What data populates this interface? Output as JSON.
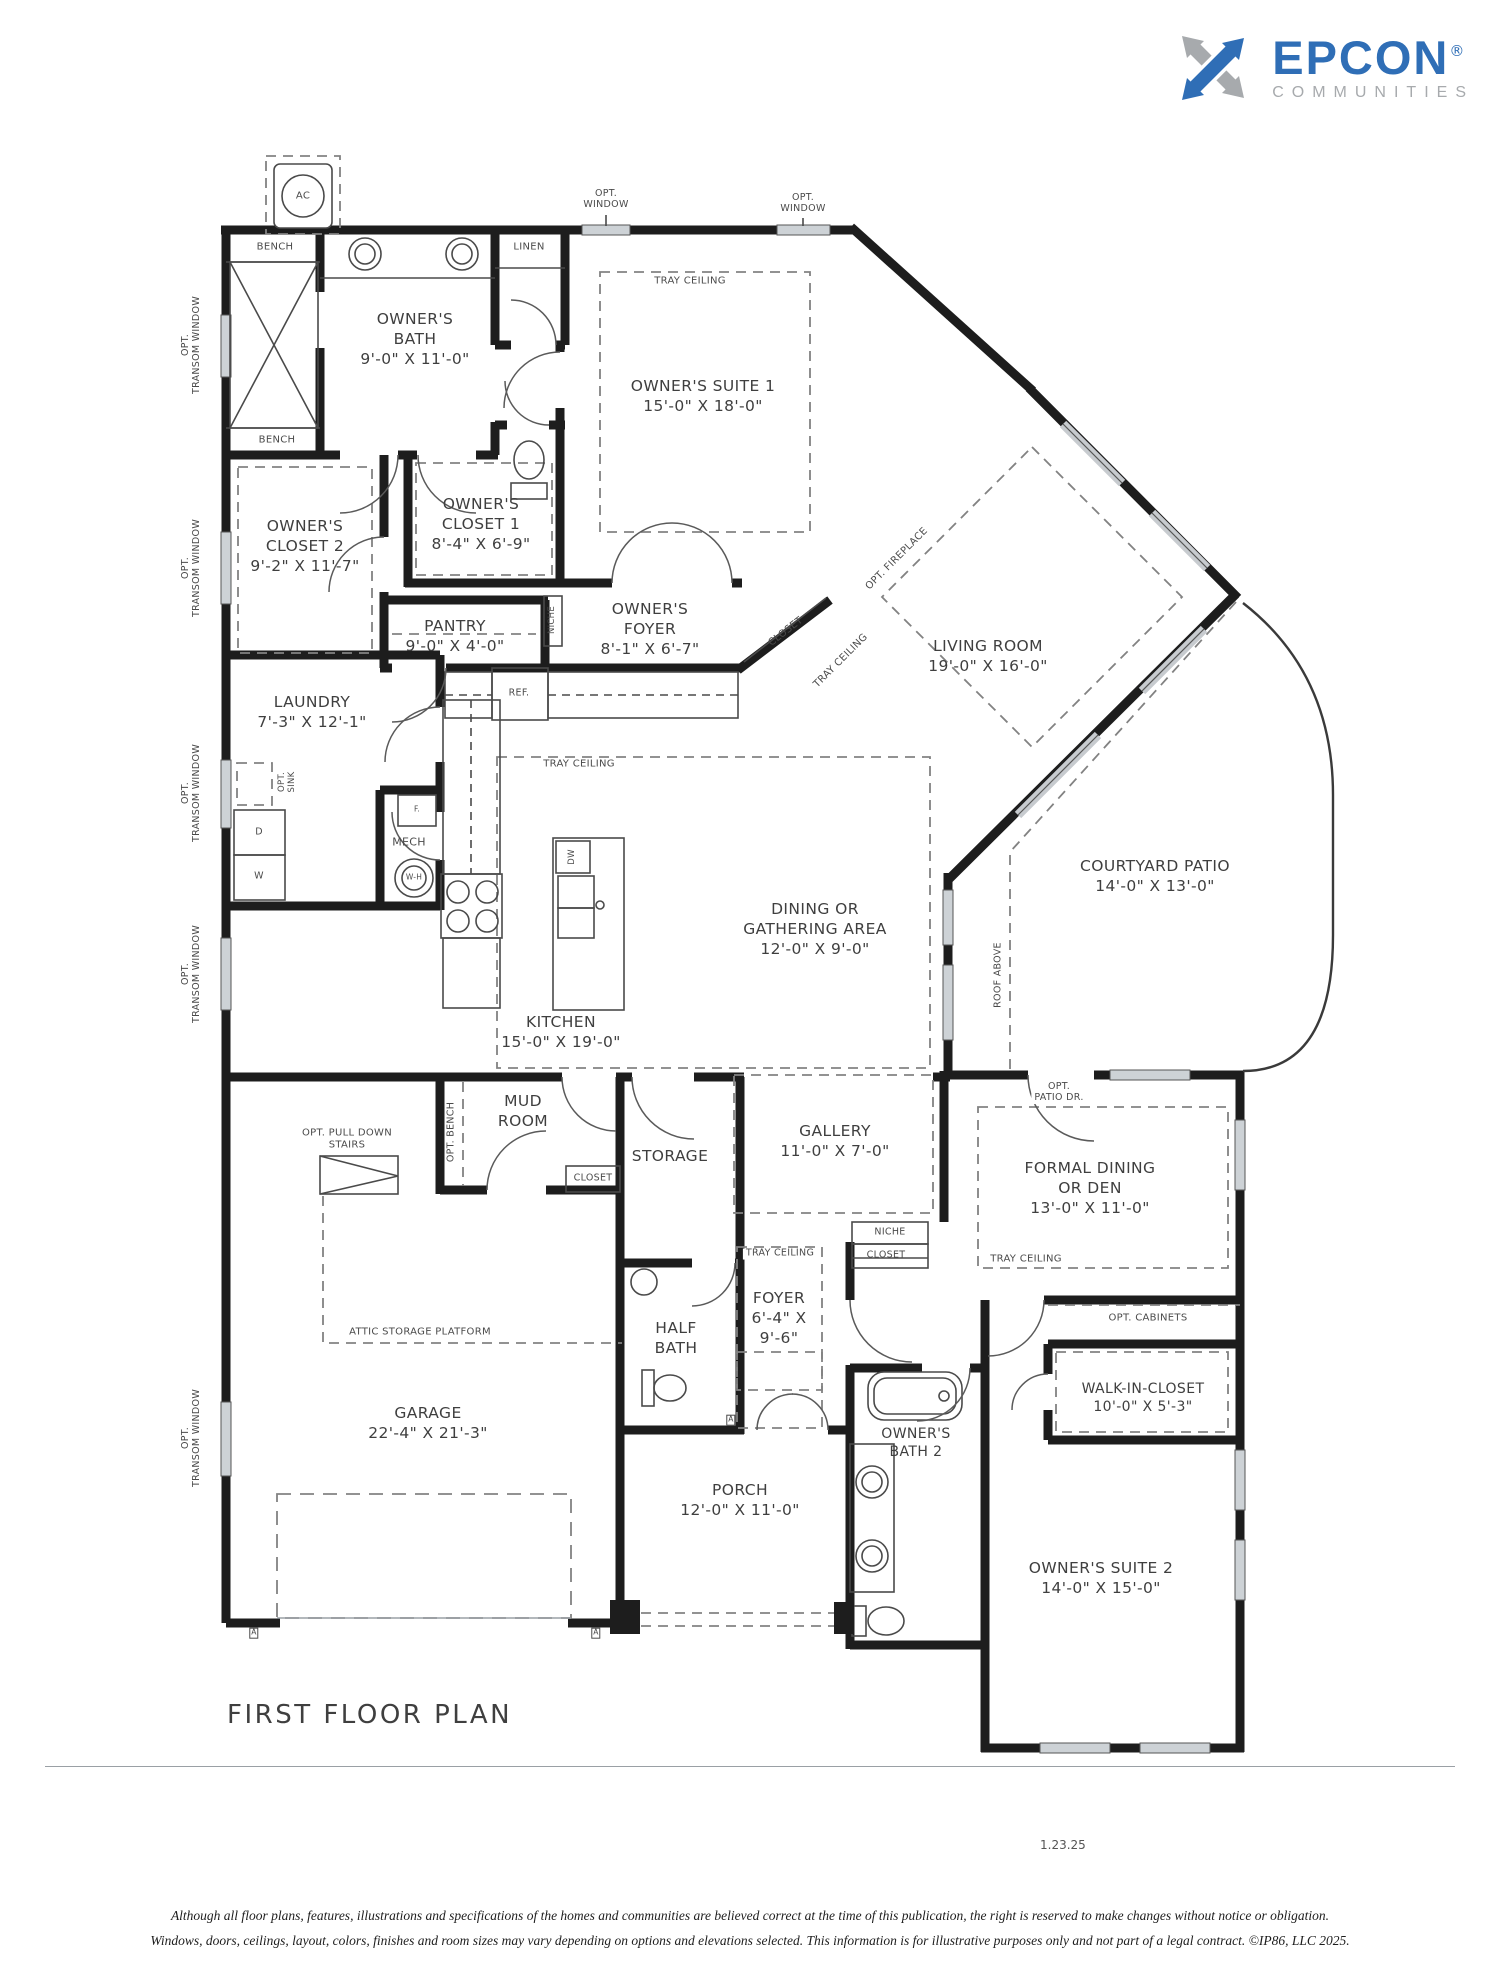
{
  "logo": {
    "brand": "EPCON",
    "reg": "®",
    "tagline": "COMMUNITIES",
    "brand_color": "#2f6eb6",
    "gray_color": "#a7aaad"
  },
  "footer": {
    "plan_title": "FIRST FLOOR PLAN",
    "date": "1.23.25",
    "disclaimer_line1": "Although all floor plans, features, illustrations and specifications of the homes and communities are believed correct at the time of this publication, the right is reserved to make changes without notice or obligation.",
    "disclaimer_line2": "Windows, doors, ceilings, layout, colors, finishes and room sizes may vary depending on options and elevations selected. This information is for illustrative purposes only and not part of a legal contract.  ©IP86, LLC 2025."
  },
  "rooms": {
    "owners_bath": {
      "name": "OWNER'S\nBATH",
      "dims": "9'-0\" X 11'-0\""
    },
    "owners_suite_1": {
      "name": "OWNER'S SUITE 1",
      "dims": "15'-0\" X 18'-0\""
    },
    "owners_closet_1": {
      "name": "OWNER'S\nCLOSET 1",
      "dims": "8'-4\" X 6'-9\""
    },
    "owners_closet_2": {
      "name": "OWNER'S\nCLOSET 2",
      "dims": "9'-2\" X 11'-7\""
    },
    "pantry": {
      "name": "PANTRY",
      "dims": "9'-0\" X 4'-0\""
    },
    "owners_foyer": {
      "name": "OWNER'S\nFOYER",
      "dims": "8'-1\" X 6'-7\""
    },
    "laundry": {
      "name": "LAUNDRY",
      "dims": "7'-3\" X 12'-1\""
    },
    "living_room": {
      "name": "LIVING ROOM",
      "dims": "19'-0\" X 16'-0\""
    },
    "courtyard_patio": {
      "name": "COURTYARD PATIO",
      "dims": "14'-0\" X 13'-0\""
    },
    "dining": {
      "name": "DINING OR\nGATHERING AREA",
      "dims": "12'-0\" X 9'-0\""
    },
    "kitchen": {
      "name": "KITCHEN",
      "dims": "15'-0\" X 19'-0\""
    },
    "mud_room": {
      "name": "MUD\nROOM"
    },
    "gallery": {
      "name": "GALLERY",
      "dims": "11'-0\" X 7'-0\""
    },
    "formal_dining": {
      "name": "FORMAL DINING\nOR DEN",
      "dims": "13'-0\" X 11'-0\""
    },
    "storage": {
      "name": "STORAGE"
    },
    "foyer": {
      "name": "FOYER",
      "dims": "6'-4\" X\n9'-6\""
    },
    "half_bath": {
      "name": "HALF\nBATH"
    },
    "walk_in_closet": {
      "name": "WALK-IN-CLOSET",
      "dims": "10'-0\" X 5'-3\""
    },
    "garage": {
      "name": "GARAGE",
      "dims": "22'-4\" X 21'-3\""
    },
    "owners_bath_2": {
      "name": "OWNER'S\nBATH 2"
    },
    "porch": {
      "name": "PORCH",
      "dims": "12'-0\" X 11'-0\""
    },
    "owners_suite_2": {
      "name": "OWNER'S SUITE 2",
      "dims": "14'-0\" X 15'-0\""
    }
  },
  "annotations": {
    "ac": "AC",
    "bench": "BENCH",
    "linen": "LINEN",
    "opt_window": "OPT.\nWINDOW",
    "tray_ceiling": "TRAY CEILING",
    "opt_transom_window": "OPT.\nTRANSOM WINDOW",
    "niche": "NICHE",
    "closet": "CLOSET",
    "opt_fireplace": "OPT. FIREPLACE",
    "ref": "REF.",
    "opt_sink": "OPT.\nSINK",
    "mech": "MECH",
    "furnace": "F.",
    "water_heater": "W-H",
    "dryer": "D",
    "washer": "W",
    "dishwasher": "DW",
    "roof_above": "ROOF ABOVE",
    "opt_patio_dr": "OPT.\nPATIO DR.",
    "opt_bench": "OPT. BENCH",
    "opt_cabinets": "OPT. CABINETS",
    "opt_pull_down_stairs": "OPT. PULL DOWN\nSTAIRS",
    "attic_storage": "ATTIC STORAGE PLATFORM",
    "marker_a": "A"
  }
}
